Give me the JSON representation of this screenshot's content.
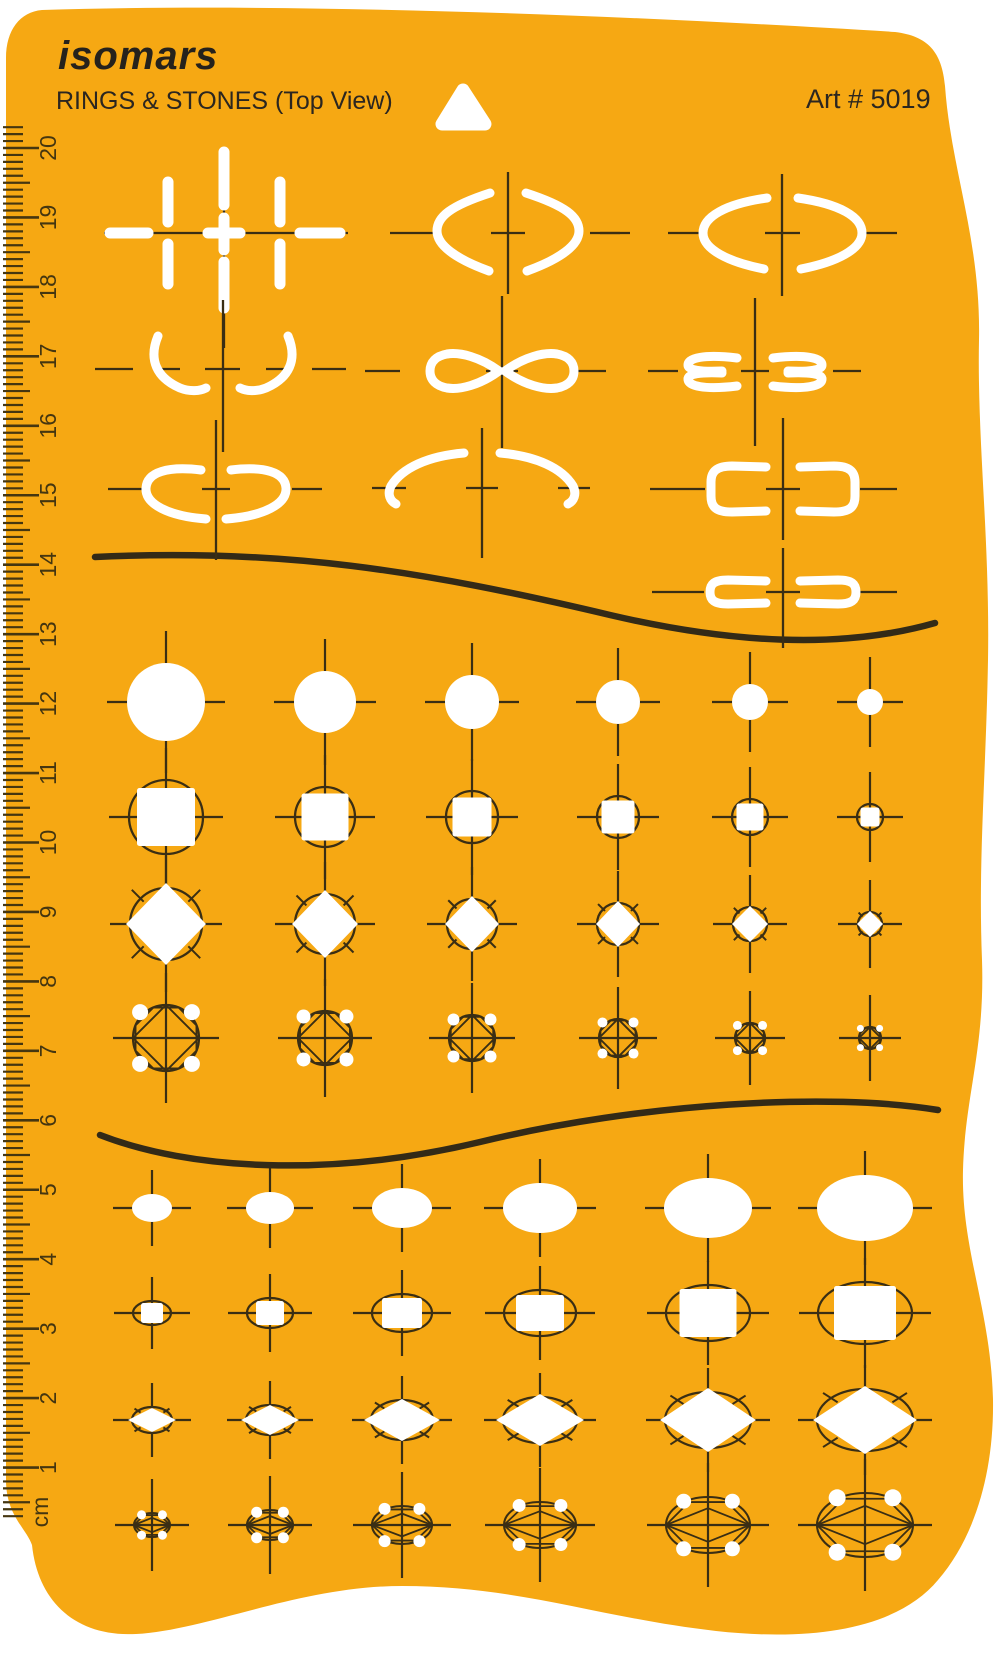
{
  "header": {
    "brand": "isomars",
    "title": "RINGS & STONES (Top View)",
    "art_number": "Art # 5019"
  },
  "colors": {
    "template_orange": "#F6A813",
    "engraved_line": "#3A2E14",
    "wavy_divider": "#332A17",
    "ruler_tick": "#453610",
    "text_dark": "#2B2620",
    "cutout_white": "#FFFFFF"
  },
  "ruler": {
    "unit_label": "cm",
    "numbers": [
      20,
      19,
      18,
      17,
      16,
      15,
      14,
      13,
      12,
      11,
      10,
      9,
      8,
      7,
      6,
      5,
      4,
      3,
      2,
      1
    ]
  },
  "top_section": {
    "name": "ring-shank-profiles",
    "row_items": [
      [
        "straight-band-slots",
        "tapered-shank-curves",
        "oval-shank-arcs"
      ],
      [
        "curved-wing-shank",
        "teardrop-loop-shank",
        "double-rail-shank"
      ],
      [
        "flat-top-shank",
        "swoosh-shank",
        "rounded-bracket-shank"
      ],
      [
        "flat-bracket-shank"
      ]
    ]
  },
  "round_stone_grid": {
    "columns_x": [
      166,
      325,
      472,
      618,
      750,
      870
    ],
    "rows": [
      {
        "kind": "circle",
        "y": 702,
        "circle_r": [
          39,
          31,
          27,
          22,
          18,
          13
        ]
      },
      {
        "kind": "square_in_circle",
        "y": 817,
        "circle_r": [
          37,
          30,
          26,
          21,
          18,
          13
        ],
        "square": [
          58,
          47,
          39,
          33,
          27,
          19
        ]
      },
      {
        "kind": "diamond_in_circle",
        "y": 924,
        "circle_r": [
          36,
          30,
          25,
          21,
          17,
          12
        ],
        "diamond_hw": [
          40,
          33,
          27,
          22,
          18,
          13
        ],
        "diamond_hh": [
          41,
          34,
          28,
          23,
          18,
          13
        ]
      },
      {
        "kind": "brilliant",
        "y": 1038,
        "circle_r": [
          33,
          27,
          23,
          19,
          15,
          11
        ],
        "prong_r": [
          8,
          7,
          6,
          5,
          4.5,
          3.5
        ]
      }
    ]
  },
  "oval_stone_grid": {
    "columns_x": [
      152,
      270,
      402,
      540,
      708,
      865
    ],
    "rows": [
      {
        "kind": "ellipse",
        "y": 1208,
        "rx": [
          20,
          24,
          30,
          37,
          44,
          48
        ],
        "ry": [
          14,
          16,
          20,
          25,
          30,
          33
        ]
      },
      {
        "kind": "square_in_ellipse",
        "y": 1313,
        "rx": [
          19,
          23,
          30,
          36,
          42,
          47
        ],
        "ry": [
          12,
          15,
          19,
          23,
          28,
          31
        ],
        "sq_w": [
          22,
          28,
          40,
          48,
          57,
          62
        ],
        "sq_h": [
          20,
          24,
          30,
          36,
          48,
          54
        ]
      },
      {
        "kind": "diamond_in_ellipse",
        "y": 1420,
        "rx": [
          20,
          24,
          31,
          37,
          43,
          48
        ],
        "ry": [
          13,
          15,
          20,
          23,
          28,
          31
        ],
        "d_hw": [
          24,
          29,
          38,
          44,
          48,
          52
        ],
        "d_hh": [
          12,
          15,
          21,
          26,
          32,
          34
        ]
      },
      {
        "kind": "faceted_oval",
        "y": 1525,
        "rx": [
          18,
          23,
          30,
          36,
          42,
          48
        ],
        "ry": [
          12,
          15,
          19,
          23,
          28,
          32
        ],
        "prong_r": [
          4.5,
          5.5,
          6,
          6.5,
          7.5,
          8.5
        ]
      }
    ]
  }
}
